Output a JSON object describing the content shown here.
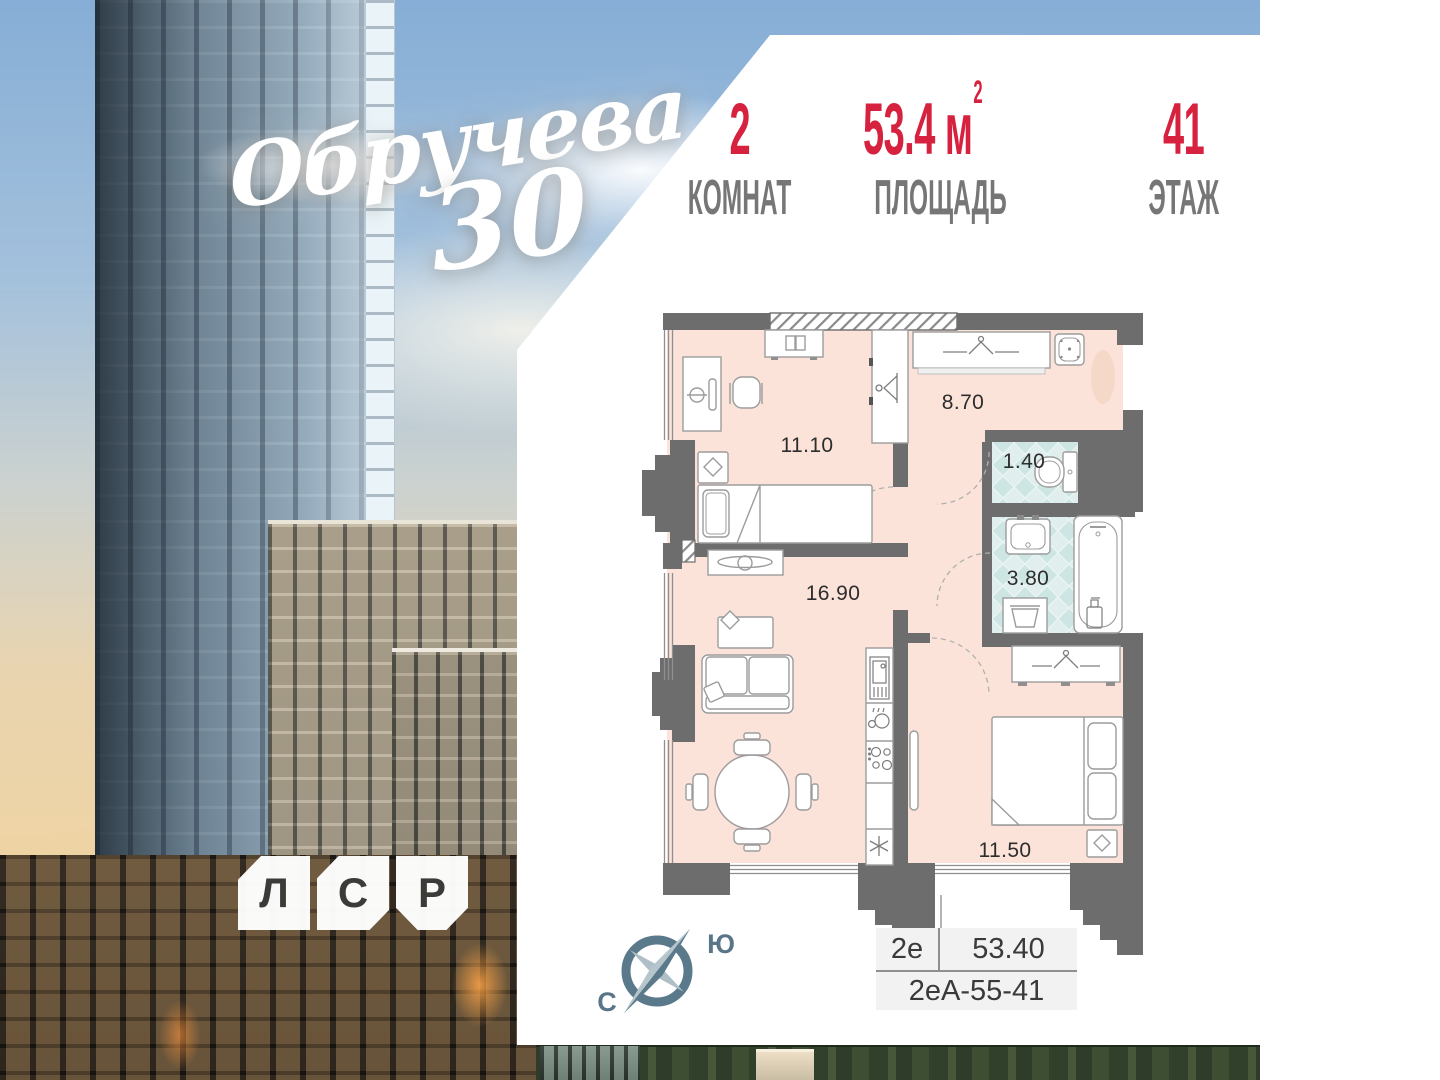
{
  "branding": {
    "project_name": "Обручева",
    "project_number": "30",
    "developer_logo_letters": [
      "Л",
      "С",
      "Р"
    ]
  },
  "header": {
    "stats": [
      {
        "value": "2",
        "sup": "",
        "label": "КОМНАТ"
      },
      {
        "value": "53.4 м",
        "sup": "2",
        "label": "ПЛОЩАДЬ"
      },
      {
        "value": "41",
        "sup": "",
        "label": "ЭТАЖ"
      }
    ]
  },
  "plan": {
    "room_areas": {
      "bedroom1": "11.10",
      "hallway": "8.70",
      "wc": "1.40",
      "bathroom": "3.80",
      "living_kitchen": "16.90",
      "bedroom2": "11.50"
    },
    "unit": {
      "type": "2е",
      "total_area": "53.40",
      "code": "2еА-55-41"
    }
  },
  "compass": {
    "south_label": "Ю",
    "north_label": "С"
  },
  "colors": {
    "accent_red": "#d6213f",
    "wall_gray": "#6d6d6d",
    "floor_pink": "#fbe3da",
    "wet_zone_teal": "#d9edec",
    "compass_slate": "#5a7a8b"
  }
}
